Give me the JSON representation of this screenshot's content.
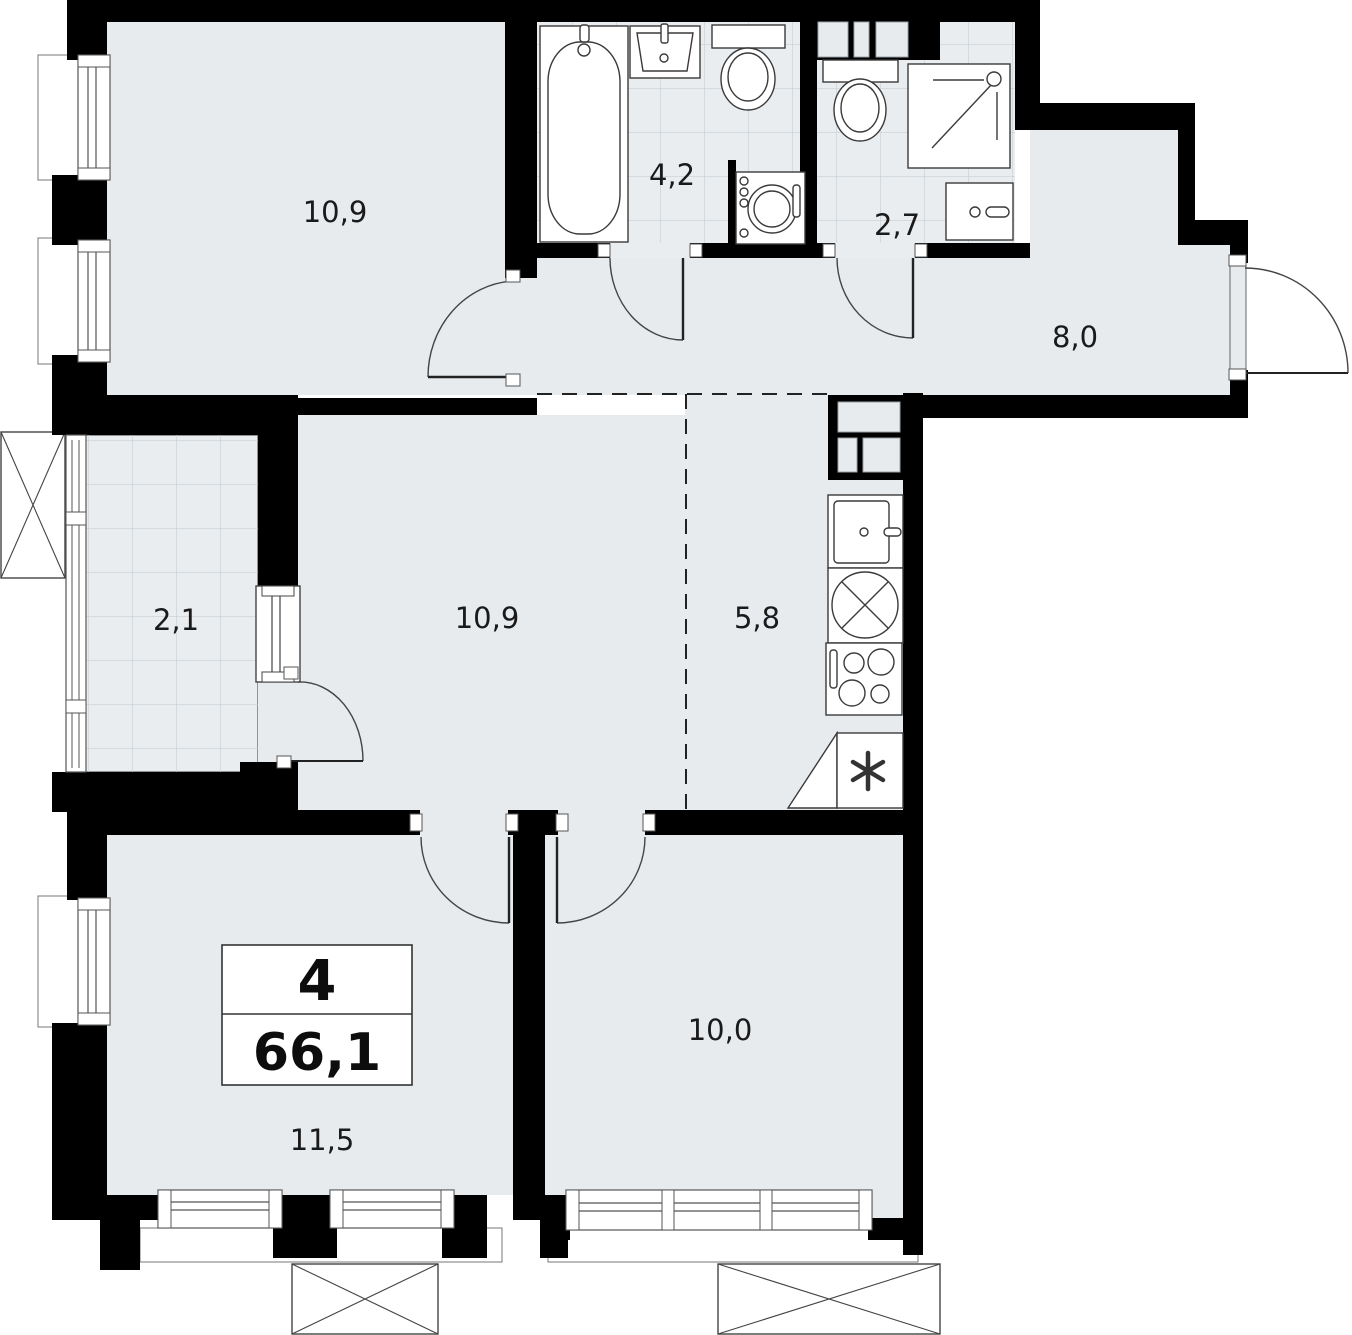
{
  "plan": {
    "title": "apartment-floor-plan",
    "summary": {
      "rooms_count": "4",
      "total_area": "66,1"
    },
    "rooms": [
      {
        "name": "room-top-left",
        "area": "10,9"
      },
      {
        "name": "bathroom",
        "area": "4,2"
      },
      {
        "name": "toilet-shower",
        "area": "2,7"
      },
      {
        "name": "hallway",
        "area": "8,0"
      },
      {
        "name": "balcony",
        "area": "2,1"
      },
      {
        "name": "room-central",
        "area": "10,9"
      },
      {
        "name": "kitchen",
        "area": "5,8"
      },
      {
        "name": "room-bottom-left",
        "area": "11,5"
      },
      {
        "name": "room-bottom-right",
        "area": "10,0"
      }
    ],
    "colors": {
      "wall": "#000000",
      "floor": "#e7ebee",
      "tile_floor": "#eaedf0",
      "tile_line": "#c7cdd2",
      "outline": "#3c3c3c",
      "background": "#ffffff"
    }
  }
}
